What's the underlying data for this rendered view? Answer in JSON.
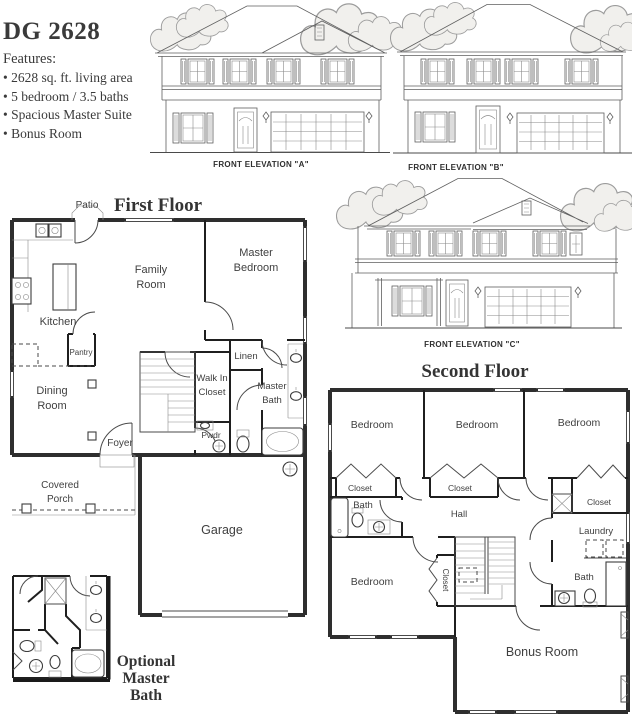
{
  "header": {
    "title": "DG 2628",
    "features_heading": "Features:",
    "features": [
      "• 2628 sq. ft. living area",
      "• 5 bedroom / 3.5 baths",
      "• Spacious Master Suite",
      "• Bonus Room"
    ]
  },
  "elevations": {
    "a": "FRONT ELEVATION \"A\"",
    "b": "FRONT ELEVATION \"B\"",
    "c": "FRONT ELEVATION \"C\""
  },
  "first_floor": {
    "heading": "First Floor",
    "patio": "Patio",
    "family_room": [
      "Family",
      "Room"
    ],
    "master_bedroom": [
      "Master",
      "Bedroom"
    ],
    "kitchen": "Kitchen",
    "pantry": "Pantry",
    "dining_room": [
      "Dining",
      "Room"
    ],
    "walk_in_closet": [
      "Walk In",
      "Closet"
    ],
    "linen": "Linen",
    "master_bath": [
      "Master",
      "Bath"
    ],
    "powder": "Pwdr",
    "foyer": "Foyer",
    "covered_porch": [
      "Covered",
      "Porch"
    ],
    "garage": "Garage"
  },
  "second_floor": {
    "heading": "Second Floor",
    "bedroom1": "Bedroom",
    "bedroom2": "Bedroom",
    "bedroom3": "Bedroom",
    "bedroom4": "Bedroom",
    "closet1": "Closet",
    "closet2": "Closet",
    "closet3": "Closet",
    "closet4": "Closet",
    "bath1": "Bath",
    "bath2": "Bath",
    "hall": "Hall",
    "laundry": "Laundry",
    "bonus_room": "Bonus Room"
  },
  "optional_bath": {
    "caption": [
      "Optional",
      "Master",
      "Bath"
    ]
  },
  "colors": {
    "ink": "#3a3a3a",
    "plan_wall": "#2e2e2e",
    "elevation_line": "#5f5f5f",
    "label": "#3f3f3f",
    "background": "#ffffff"
  }
}
